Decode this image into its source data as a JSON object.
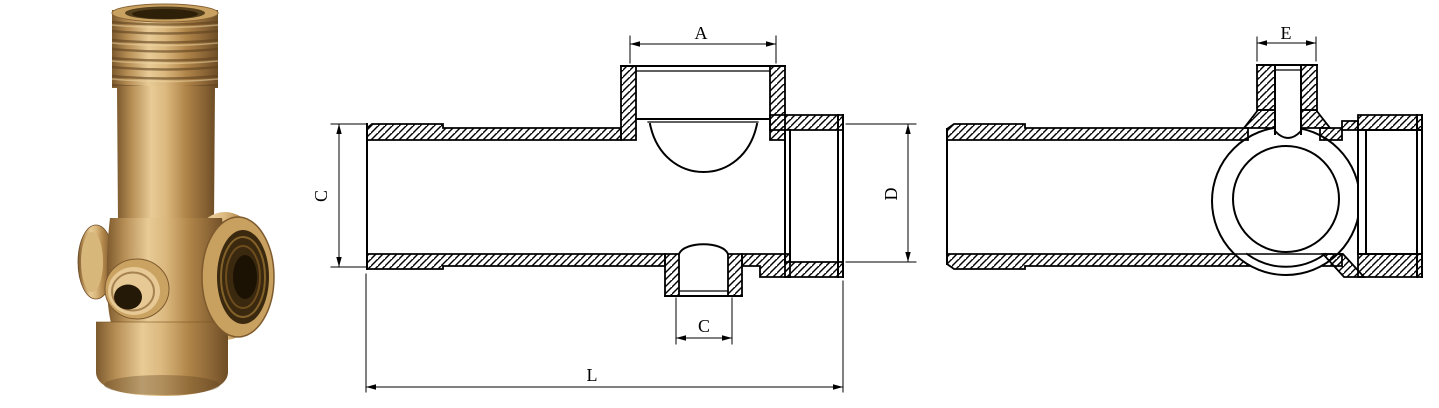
{
  "page": {
    "background": "#ffffff",
    "line_color": "#000000"
  },
  "product_photo": {
    "name": "brass five-way pump flange fitting",
    "brass_highlight": "#e8cb96",
    "brass_mid": "#c8a05f",
    "brass_shadow": "#6e4d26",
    "bore_color": "#241806"
  },
  "front_section_view": {
    "name": "front cross-section view",
    "dims": {
      "top_port_width": "A",
      "body_diameter": "C",
      "bottom_port_width": "C",
      "outlet_diameter": "D",
      "overall_length": "L"
    }
  },
  "side_section_view": {
    "name": "side cross-section view",
    "dims": {
      "gauge_port_width": "E"
    }
  }
}
